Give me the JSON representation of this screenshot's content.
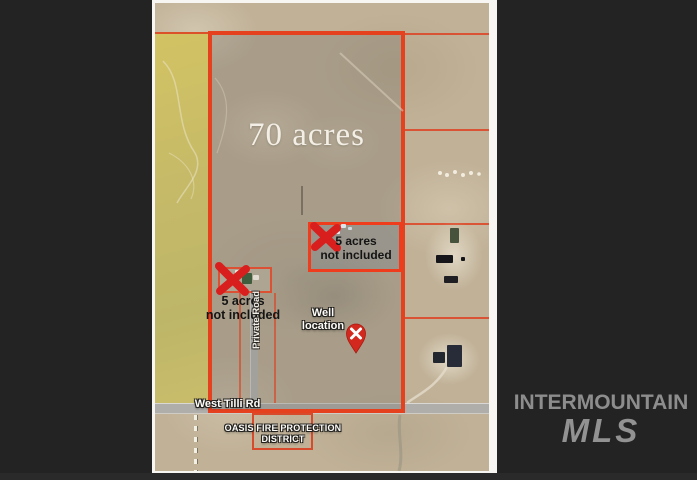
{
  "watermark": {
    "line1": "INTERMOUNTAIN",
    "line2": "MLS"
  },
  "map": {
    "parcel_label": "70 acres",
    "exclusion_upper": {
      "line1": "5 acres",
      "line2": "not included"
    },
    "exclusion_left": {
      "line1": "5 acres",
      "line2": "not included"
    },
    "well": {
      "line1": "Well",
      "line2": "location"
    },
    "road_label": "West Tilli Rd",
    "private_road_label": "Private Road",
    "fire_district": {
      "line1": "OASIS FIRE PROTECTION",
      "line2": "DISTRICT"
    }
  },
  "colors": {
    "boundary_red": "#e6411f",
    "x_mark_red": "#d91e1e",
    "pin_red": "#d3281e",
    "watermark_gray": "#8d8d8d",
    "background_dark": "#232323"
  }
}
